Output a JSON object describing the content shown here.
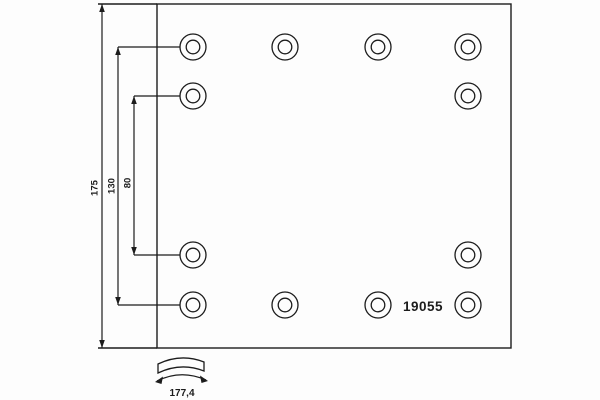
{
  "drawing": {
    "background": "#fdfdfd",
    "ink": "#1c1c1c",
    "part_number": "19055",
    "arc_width_label": "177,4",
    "plate": {
      "x1": 157,
      "y1": 4,
      "x2": 511,
      "y2": 348
    },
    "edge_extension_x": 98,
    "holes": {
      "outer_radius": 13,
      "inner_radius": 6.8,
      "centers": [
        {
          "x": 193,
          "y": 47
        },
        {
          "x": 285,
          "y": 47
        },
        {
          "x": 378,
          "y": 47
        },
        {
          "x": 468,
          "y": 47
        },
        {
          "x": 193,
          "y": 96
        },
        {
          "x": 468,
          "y": 96
        },
        {
          "x": 193,
          "y": 255
        },
        {
          "x": 468,
          "y": 255
        },
        {
          "x": 193,
          "y": 305
        },
        {
          "x": 285,
          "y": 305
        },
        {
          "x": 378,
          "y": 305
        },
        {
          "x": 468,
          "y": 305
        }
      ]
    },
    "vertical_dimensions": [
      {
        "label": "175",
        "x": 102,
        "y1": 4,
        "y2": 348,
        "label_x": 95,
        "label_y": 188
      },
      {
        "label": "130",
        "x": 118,
        "y1": 47,
        "y2": 305,
        "label_x": 112,
        "label_y": 186
      },
      {
        "label": "80",
        "x": 134,
        "y1": 96,
        "y2": 255,
        "label_x": 128,
        "label_y": 183
      }
    ],
    "extension_lines": [
      {
        "x1": 118,
        "y1": 47,
        "x2": 180,
        "y2": 47
      },
      {
        "x1": 134,
        "y1": 96,
        "x2": 180,
        "y2": 96
      },
      {
        "x1": 134,
        "y1": 255,
        "x2": 180,
        "y2": 255
      },
      {
        "x1": 118,
        "y1": 305,
        "x2": 180,
        "y2": 305
      }
    ],
    "part_number_anchor": {
      "x": 423,
      "y": 311
    },
    "arc_symbol": {
      "band_path": "M158,364 Q181,353 204,362 L204,371 Q181,362 158,373 Z",
      "arrow_path": "M157,381 Q181,369 206,380",
      "arrowheads": [
        {
          "points": "155,382 163,376.5 161.5,384"
        },
        {
          "points": "208,381 200,375.5 201.5,383"
        }
      ],
      "label_x": 182,
      "label_y": 396
    }
  }
}
